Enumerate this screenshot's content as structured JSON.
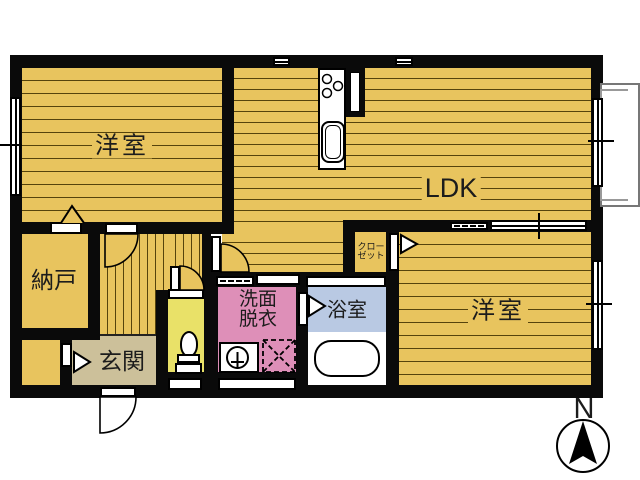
{
  "title": "floor-plan",
  "rooms": {
    "bedroom1": {
      "label": "洋室"
    },
    "ldk": {
      "label": "LDK"
    },
    "storage": {
      "label": "納戸"
    },
    "entrance": {
      "label": "玄関"
    },
    "washroom": {
      "label_line1": "洗面",
      "label_line2": "脱衣"
    },
    "bathroom": {
      "label": "浴室"
    },
    "closet": {
      "label_line1": "クロー",
      "label_line2": "ゼット"
    },
    "bedroom2": {
      "label": "洋室"
    }
  },
  "compass": {
    "label": "N",
    "direction": "up"
  },
  "palette": {
    "floor_gold": "#e8c45e",
    "floor_stripe": "#55430c",
    "toilet_yellow": "#e9e168",
    "washroom_pink": "#de8fb8",
    "bathroom_blue": "#b9c9e3",
    "entrance_beige": "#ccc09a",
    "wall_black": "#0a0a0a",
    "balcony_gray": "#777777"
  },
  "icons": [
    "kitchen-stove-icon",
    "kitchen-sink-icon",
    "toilet-icon",
    "bathtub-icon",
    "washbasin-icon",
    "washing-machine-icon",
    "compass-icon",
    "door-swing-arc",
    "folding-door-chevron",
    "window-glyph"
  ]
}
